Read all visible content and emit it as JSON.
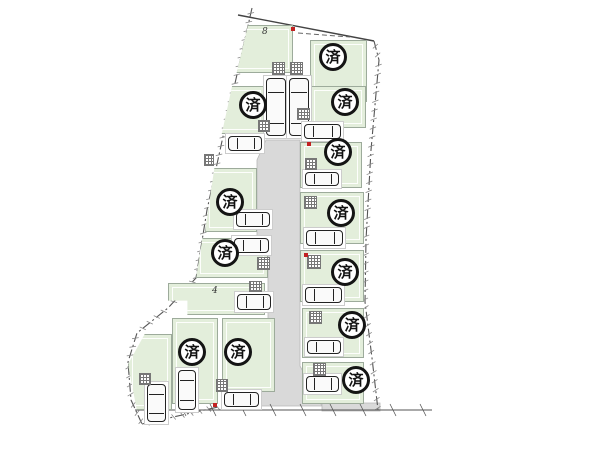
{
  "diagram": {
    "type": "residential-site-plan",
    "sold_mark": "済",
    "colors": {
      "parcel_fill": "#e3eedb",
      "road_fill": "#d9d9d9",
      "outline": "#555555",
      "sold_ring": "#141414",
      "red_marker": "#c22222"
    },
    "road": {
      "path": "M266,140 L300,140 L300,366 L322,406 L252,406 L268,366 L268,250 L257,246 L257,160 Z",
      "strip": "M322,403 L380,403 L380,411 L322,411 Z"
    },
    "boundaries": [
      {
        "name": "top-boundary",
        "points": [
          [
            238,
            15
          ],
          [
            374,
            41
          ]
        ],
        "style": "solid",
        "ticks": false,
        "color": "#444",
        "width": 1.4
      },
      {
        "name": "right-boundary",
        "points": [
          [
            374,
            41
          ],
          [
            379,
            60
          ],
          [
            371,
            150
          ],
          [
            366,
            240
          ],
          [
            365,
            302
          ],
          [
            372,
            358
          ],
          [
            378,
            410
          ]
        ],
        "style": "dashdot",
        "ticks": true,
        "color": "#555",
        "width": 1.1
      },
      {
        "name": "left-boundary",
        "points": [
          [
            252,
            8
          ],
          [
            224,
            132
          ],
          [
            207,
            210
          ],
          [
            196,
            278
          ],
          [
            168,
            308
          ],
          [
            137,
            333
          ],
          [
            128,
            362
          ],
          [
            131,
            400
          ],
          [
            142,
            424
          ]
        ],
        "style": "dashdot",
        "ticks": true,
        "color": "#555",
        "width": 1.1
      },
      {
        "name": "bottom-left-edge",
        "points": [
          [
            142,
            424
          ],
          [
            218,
            407
          ]
        ],
        "style": "dashdot",
        "ticks": true,
        "color": "#555",
        "width": 1.1
      },
      {
        "name": "bottom-road-line",
        "points": [
          [
            135,
            410
          ],
          [
            432,
            410
          ]
        ],
        "style": "solid",
        "ticks": "spaced",
        "color": "#555",
        "width": 1.1
      },
      {
        "name": "setback-dashed-line",
        "points": [
          [
            298,
            33
          ],
          [
            350,
            37
          ]
        ],
        "style": "dashed",
        "ticks": false,
        "color": "#666",
        "width": 1
      }
    ],
    "lots": [
      {
        "id": "8",
        "status": "available",
        "rect": [
          233,
          25,
          60,
          48
        ],
        "clip": "polygon(25% 0, 100% 0, 100% 100%, 6% 100%)"
      },
      {
        "id": "a",
        "status": "sold",
        "rect": [
          218,
          86,
          47,
          48
        ],
        "clip": "polygon(30% 0, 100% 0, 100% 100%, 8% 100%)"
      },
      {
        "id": "b",
        "status": "sold",
        "rect": [
          205,
          168,
          52,
          64
        ],
        "clip": "polygon(18% 0, 100% 0, 100% 100%, 0 100%)"
      },
      {
        "id": "c",
        "status": "sold",
        "rect": [
          196,
          238,
          72,
          40
        ],
        "clip": "polygon(9% 0, 100% 0, 100% 100%, 0 100%)"
      },
      {
        "id": "4",
        "status": "available",
        "rect": [
          168,
          283,
          97,
          32
        ],
        "clip": "polygon(0 0, 100% 0, 100% 100%, 20% 100%, 20% 55%, 0 55%)"
      },
      {
        "id": "d",
        "status": "sold",
        "rect": [
          172,
          318,
          46,
          86
        ]
      },
      {
        "id": "e",
        "status": "sold",
        "rect": [
          222,
          318,
          53,
          74
        ]
      },
      {
        "id": "bl",
        "status": "available",
        "rect": [
          128,
          334,
          44,
          76
        ],
        "clip": "polygon(38% 0, 100% 0, 100% 100%, 20% 100%, 0 40%)"
      },
      {
        "id": "f",
        "status": "sold",
        "rect": [
          310,
          40,
          57,
          62
        ]
      },
      {
        "id": "g",
        "status": "sold",
        "rect": [
          310,
          86,
          56,
          42
        ]
      },
      {
        "id": "h",
        "status": "sold",
        "rect": [
          300,
          142,
          62,
          46
        ]
      },
      {
        "id": "i",
        "status": "sold",
        "rect": [
          300,
          192,
          64,
          52
        ]
      },
      {
        "id": "j",
        "status": "sold",
        "rect": [
          300,
          250,
          64,
          52
        ]
      },
      {
        "id": "k",
        "status": "sold",
        "rect": [
          302,
          308,
          62,
          50
        ]
      },
      {
        "id": "l",
        "status": "sold",
        "rect": [
          302,
          362,
          62,
          42
        ]
      }
    ],
    "sold_circles": [
      [
        333,
        57
      ],
      [
        345,
        102
      ],
      [
        338,
        152
      ],
      [
        341,
        213
      ],
      [
        345,
        272
      ],
      [
        352,
        325
      ],
      [
        356,
        380
      ],
      [
        253,
        105
      ],
      [
        230,
        202
      ],
      [
        225,
        253
      ],
      [
        192,
        352
      ],
      [
        238,
        352
      ]
    ],
    "number_labels": [
      {
        "text": "8",
        "x": 262,
        "y": 27
      },
      {
        "text": "4",
        "x": 212,
        "y": 286
      }
    ],
    "cars": [
      {
        "rect": [
          266,
          78,
          20,
          58
        ],
        "orient": "v"
      },
      {
        "rect": [
          289,
          78,
          20,
          58
        ],
        "orient": "v"
      },
      {
        "rect": [
          228,
          136,
          34,
          15
        ],
        "orient": "h"
      },
      {
        "rect": [
          236,
          212,
          34,
          15
        ],
        "orient": "h"
      },
      {
        "rect": [
          234,
          238,
          35,
          15
        ],
        "orient": "h"
      },
      {
        "rect": [
          237,
          294,
          34,
          16
        ],
        "orient": "h"
      },
      {
        "rect": [
          178,
          370,
          18,
          40
        ],
        "orient": "v"
      },
      {
        "rect": [
          147,
          384,
          19,
          38
        ],
        "orient": "v"
      },
      {
        "rect": [
          224,
          392,
          35,
          15
        ],
        "orient": "h"
      },
      {
        "rect": [
          304,
          124,
          37,
          15
        ],
        "orient": "h"
      },
      {
        "rect": [
          305,
          172,
          34,
          14
        ],
        "orient": "h"
      },
      {
        "rect": [
          306,
          230,
          37,
          16
        ],
        "orient": "h"
      },
      {
        "rect": [
          305,
          287,
          37,
          16
        ],
        "orient": "h"
      },
      {
        "rect": [
          307,
          340,
          34,
          14
        ],
        "orient": "h"
      },
      {
        "rect": [
          306,
          376,
          33,
          16
        ],
        "orient": "h"
      }
    ],
    "stairs": [
      [
        272,
        62,
        13,
        13
      ],
      [
        290,
        62,
        13,
        13
      ],
      [
        297,
        108,
        13,
        12
      ],
      [
        258,
        120,
        12,
        12
      ],
      [
        305,
        158,
        12,
        12
      ],
      [
        304,
        196,
        13,
        13
      ],
      [
        307,
        255,
        14,
        14
      ],
      [
        309,
        311,
        13,
        13
      ],
      [
        313,
        363,
        13,
        13
      ],
      [
        257,
        257,
        13,
        13
      ],
      [
        249,
        281,
        13,
        11
      ],
      [
        216,
        379,
        12,
        13
      ],
      [
        139,
        373,
        12,
        12
      ],
      [
        204,
        154,
        10,
        12
      ]
    ],
    "red_markers": [
      [
        291,
        27
      ],
      [
        307,
        142
      ],
      [
        304,
        253
      ],
      [
        213,
        403
      ]
    ]
  }
}
